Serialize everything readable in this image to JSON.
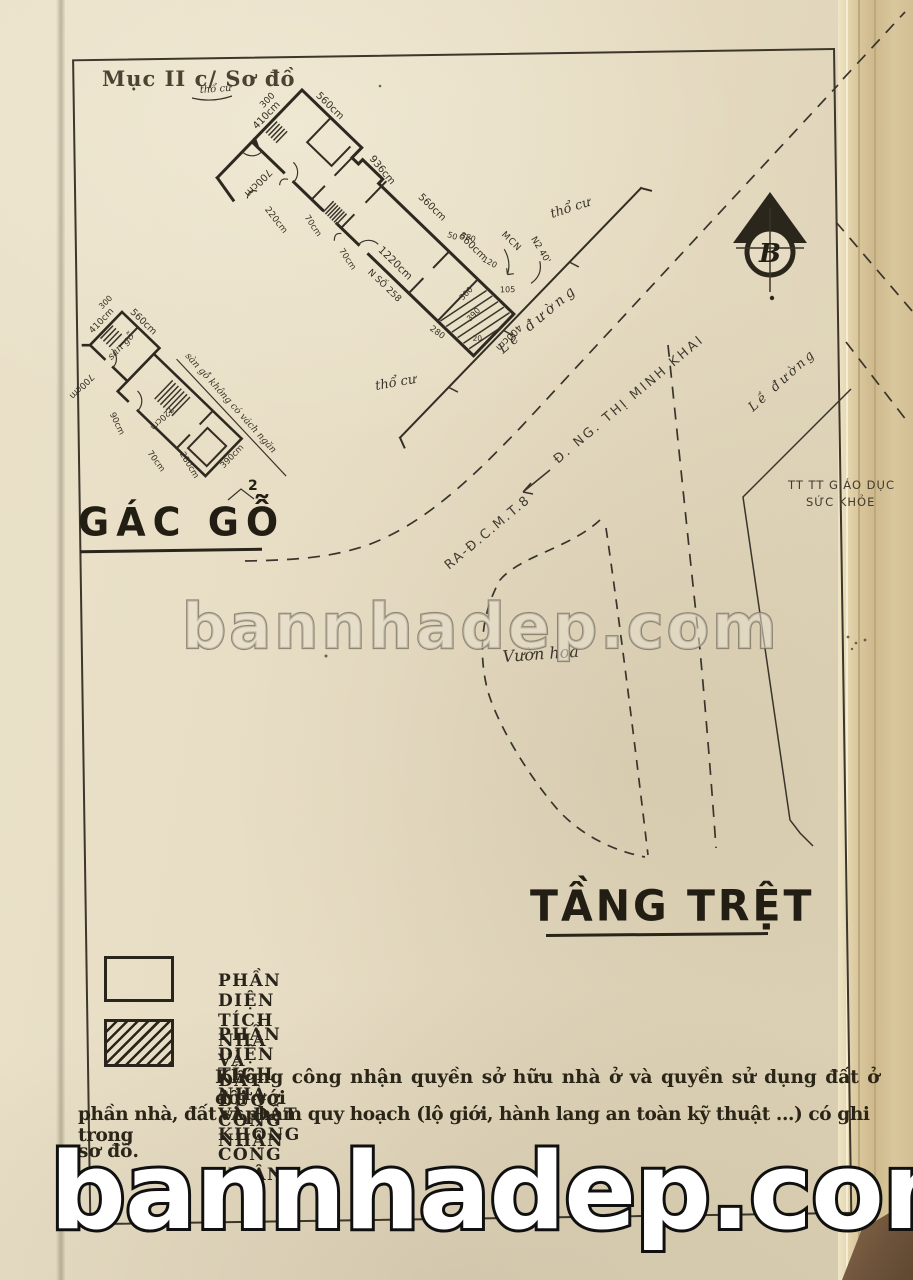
{
  "page": {
    "header": "Mục II c/ Sơ đồ",
    "header_note": "thổ cư"
  },
  "compass": {
    "north_letter": "B"
  },
  "main_plan": {
    "dims": {
      "top_560": "560cm",
      "left_410": "410cm",
      "left_300": "300",
      "left_700": "700cm",
      "upper_936": "936cm",
      "upper_560": "560cm",
      "upper_660": "660cm",
      "corridor_1220": "1220cm",
      "house_no": "N SỐ 258",
      "door_220": "220cm",
      "door_70": "70cm",
      "end_400": "400cm",
      "n50": "50",
      "n380": "380",
      "n120": "120",
      "n105": "105",
      "n300": "300",
      "n390": "390",
      "n20": "20",
      "n280": "280",
      "mcn": "MCN",
      "n2_40": "N2 40'"
    },
    "labels": {
      "tho_cu": "thổ cư",
      "le_duong": "Lề đường",
      "street_name": "Đ. NG. THỊ MINH KHAI",
      "ra_cmt8": "RA-Đ.C.M.T.8",
      "vuon_hoa": "Vườn hoa",
      "tt_line1": "TT TT GIÁO DỤC",
      "tt_line2": "SỨC KHỎE"
    }
  },
  "left_plan": {
    "dims": {
      "d410": "410cm",
      "d300": "300",
      "d560": "560cm",
      "d700": "700cm",
      "d90": "90cm",
      "d720": "720cm",
      "d280": "280cm",
      "d70": "70cm",
      "d390": "390cm"
    },
    "labels": {
      "san_go": "sàn gỗ",
      "note": "sàn gỗ không có vách ngăn",
      "gac_go": "GÁC GỖ",
      "gac_go_sup": "2"
    }
  },
  "title": {
    "text": "TẦNG TRỆT"
  },
  "legend": {
    "items": [
      {
        "label": "PHẦN DIỆN TÍCH NHÀ VÀ ĐẤT ĐƯỢC CÔNG NHẬN"
      },
      {
        "label": "PHẦN DIỆN TÍCH NHÀ VÀ ĐẤT KHÔNG CÔNG NHẬN"
      }
    ]
  },
  "note": {
    "line1": "Không công nhận quyền sở hữu nhà ở và quyền sử dụng đất ở đối với",
    "line2": "phần nhà, đất vi phạm quy hoạch (lộ giới, hành lang an toàn kỹ thuật ...) có ghi trong",
    "line3": "sơ đồ."
  },
  "watermark": {
    "text": "bannhadep.com"
  },
  "colors": {
    "paper": "#e6dcc3",
    "ink": "#2e2920",
    "fold": "#d8c69c"
  }
}
